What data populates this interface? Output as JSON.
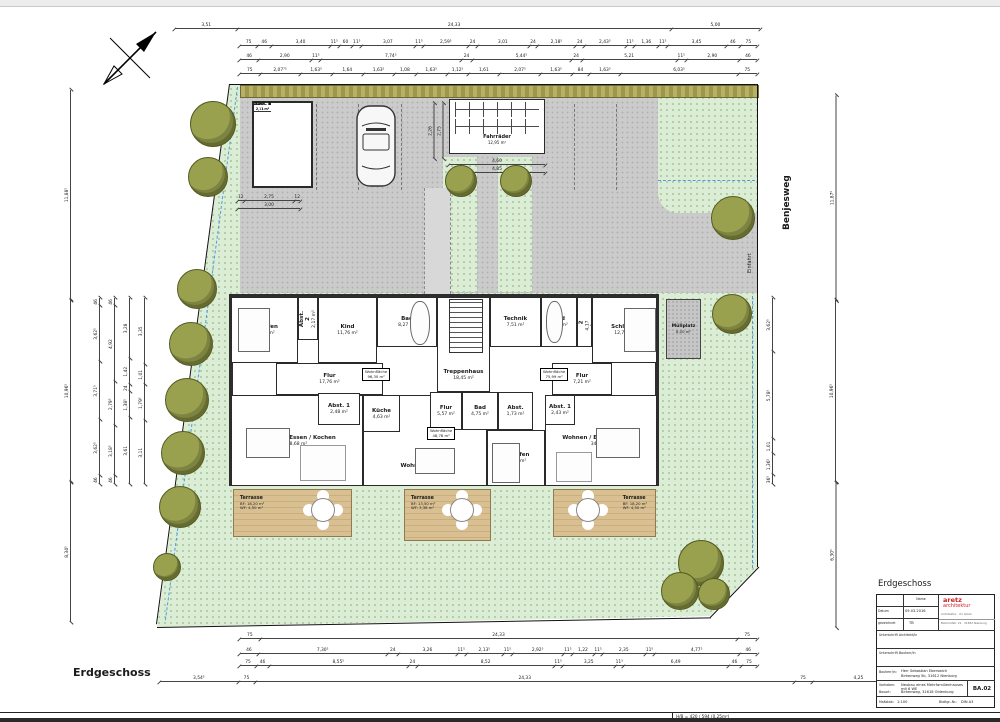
{
  "page": {
    "sheet_caption": "Erdgeschoss",
    "footer_text": "H/B = 420 / 594 (0.25m²)",
    "street_name": "Benjesweg",
    "driveway_label": "Einfahrt"
  },
  "hedge_labels": [
    {
      "t": "Hecke",
      "x": 70
    },
    {
      "t": "Hecke",
      "x": 420
    }
  ],
  "title_block": {
    "heading": "Erdgeschoss",
    "name_header": "Name",
    "date_label": "Datum",
    "date_value": "09.03.2016",
    "drawn_label": "gezeichnet",
    "drawn_value": "TB",
    "logo_line1": "aretz",
    "logo_line2": "architektur",
    "logo_sub1": "Architektur · Ihr Glück",
    "logo_sub2": "Bahnhofstr. 21 · 31582 Nienburg",
    "sig1": "Unterschrift Architekt/in",
    "sig2": "Unterschrift Bauherr/in",
    "client_label": "Bauherr/in:",
    "client_value1": "Herr Sebastian Eberswich",
    "client_value2": "Birkenweg 5b, 31612 Nienburg",
    "project_label": "Vorhaben:",
    "project_value": "Neubau eines Mehrfamilienhauses mit 6 WE",
    "site_label": "Bauort:",
    "site_value": "Birkenweg, 31618 Oldenburg",
    "sheet_no": "BA.02",
    "scale_label": "Maßstab:",
    "scale_value": "1:100",
    "format_label": "Blattgr.-Nr.:",
    "format_value": "DIN A3"
  },
  "rooms": [
    {
      "label": "Schlafen",
      "area": "17,83 m²",
      "x": 231,
      "y": 297,
      "w": 67,
      "h": 66
    },
    {
      "label": "Kind",
      "area": "11,76 m²",
      "x": 318,
      "y": 297,
      "w": 59,
      "h": 66
    },
    {
      "label": "Bad",
      "area": "8,27 m²",
      "x": 377,
      "y": 297,
      "w": 60,
      "h": 50
    },
    {
      "label": "Treppenhaus",
      "area": "18,45 m²",
      "x": 437,
      "y": 297,
      "w": 53,
      "h": 95,
      "cls": "low"
    },
    {
      "label": "Technik",
      "area": "7,51 m²",
      "x": 490,
      "y": 297,
      "w": 51,
      "h": 50
    },
    {
      "label": "Bad",
      "area": "8,54 m²",
      "x": 541,
      "y": 297,
      "w": 36,
      "h": 50
    },
    {
      "label": "Schlafen",
      "area": "12,71 m²",
      "x": 592,
      "y": 297,
      "w": 65,
      "h": 66
    },
    {
      "label": "Flur",
      "area": "17,76 m²",
      "x": 276,
      "y": 363,
      "w": 107,
      "h": 32
    },
    {
      "label": "Flur",
      "area": "7,21 m²",
      "x": 552,
      "y": 363,
      "w": 60,
      "h": 32
    },
    {
      "label": "Wohnen / Essen / Kochen",
      "area": "38,68 m²",
      "x": 231,
      "y": 395,
      "w": 132,
      "h": 91
    },
    {
      "label": "Wohnen / Essen",
      "area": "21,26 m²",
      "x": 363,
      "y": 395,
      "w": 124,
      "h": 91,
      "cls": "low"
    },
    {
      "label": "Wohnen / Essen / Kochen",
      "area": "34,06 m²",
      "x": 545,
      "y": 395,
      "w": 112,
      "h": 91
    },
    {
      "label": "Küche",
      "area": "4,63 m²",
      "x": 363,
      "y": 395,
      "w": 37,
      "h": 37
    },
    {
      "label": "Flur",
      "area": "5,57 m²",
      "x": 430,
      "y": 392,
      "w": 32,
      "h": 38
    },
    {
      "label": "Bad",
      "area": "4,75 m²",
      "x": 462,
      "y": 392,
      "w": 36,
      "h": 38
    },
    {
      "label": "Abst.",
      "area": "1,73 m²",
      "x": 498,
      "y": 392,
      "w": 35,
      "h": 38
    },
    {
      "label": "Schlafen",
      "area": "10,60 m²",
      "x": 487,
      "y": 430,
      "w": 58,
      "h": 56
    },
    {
      "label": "Abst. 1",
      "area": "2,48 m²",
      "x": 318,
      "y": 393,
      "w": 42,
      "h": 32
    },
    {
      "label": "Abst. 1",
      "area": "2,43 m²",
      "x": 545,
      "y": 395,
      "w": 30,
      "h": 30
    },
    {
      "label": "Abst. 2",
      "area": "2,17 m²",
      "x": 298,
      "y": 297,
      "w": 20,
      "h": 43,
      "rot": true
    },
    {
      "label": "Abst. 2",
      "area": "4,17 m²",
      "x": 577,
      "y": 297,
      "w": 15,
      "h": 50,
      "rot": true
    }
  ],
  "wf_boxes": [
    {
      "l1": "Wohnfläche",
      "l2": "96,30 m²",
      "x": 362,
      "y": 368
    },
    {
      "l1": "Wohnfläche",
      "l2": "48,78 m²",
      "x": 427,
      "y": 427
    },
    {
      "l1": "Wohnfläche",
      "l2": "75,99 m²",
      "x": 540,
      "y": 368
    }
  ],
  "storage_units": [
    {
      "label": "Abst. 1",
      "area": "2,11 m²"
    },
    {
      "label": "Abst. 2",
      "area": "2,11 m²"
    },
    {
      "label": "Abst. 3",
      "area": "2,11 m²"
    },
    {
      "label": "Abst. 4",
      "area": "2,11 m²"
    },
    {
      "label": "Abst. 5",
      "area": "2,11 m²"
    },
    {
      "label": "Abst. 6",
      "area": "2,11 m²"
    }
  ],
  "bike_area": {
    "label": "Fahrräder",
    "area": "12,95 m²"
  },
  "muellplatz": {
    "label": "Müllplatz",
    "area": "8,00 m²"
  },
  "stall_labels": [
    {
      "t": "Stellplatz 6",
      "x": 336
    },
    {
      "t": "Stellplatz 5",
      "x": 384
    },
    {
      "t": "Stellplatz 4",
      "x": 425
    },
    {
      "t": "Stellplatz 3",
      "x": 551
    },
    {
      "t": "Stellplatz 2",
      "x": 594
    },
    {
      "t": "Stellplatz 1",
      "x": 636
    }
  ],
  "stall_dividers": [
    {
      "x": 316
    },
    {
      "x": 358
    },
    {
      "x": 401
    },
    {
      "x": 574
    },
    {
      "x": 616
    }
  ],
  "islands": [
    {
      "x": 443,
      "y": 157,
      "w": 34,
      "h": 135
    },
    {
      "x": 498,
      "y": 157,
      "w": 34,
      "h": 135
    }
  ],
  "terraces": [
    {
      "label": "Terrasse",
      "bf": "BF: 18,20 m²",
      "wf": "WF: 4,50 m²",
      "x": 233,
      "y": 489,
      "w": 119,
      "h": 48
    },
    {
      "label": "Terrasse",
      "bf": "BF: 13,50 m²",
      "wf": "WF: 3,38 m²",
      "x": 404,
      "y": 489,
      "w": 87,
      "h": 52
    },
    {
      "label": "Terrasse",
      "bf": "BF: 18,20 m²",
      "wf": "WF: 4,50 m²",
      "x": 553,
      "y": 489,
      "w": 103,
      "h": 48,
      "flip": true
    }
  ],
  "trees": [
    {
      "x": 212,
      "y": 123,
      "r": 22
    },
    {
      "x": 207,
      "y": 176,
      "r": 19
    },
    {
      "x": 196,
      "y": 288,
      "r": 19
    },
    {
      "x": 190,
      "y": 343,
      "r": 21
    },
    {
      "x": 186,
      "y": 399,
      "r": 21
    },
    {
      "x": 182,
      "y": 452,
      "r": 21
    },
    {
      "x": 179,
      "y": 506,
      "r": 20
    },
    {
      "x": 166,
      "y": 566,
      "r": 13
    },
    {
      "x": 460,
      "y": 180,
      "r": 15
    },
    {
      "x": 515,
      "y": 180,
      "r": 15
    },
    {
      "x": 732,
      "y": 217,
      "r": 21
    },
    {
      "x": 731,
      "y": 313,
      "r": 19
    },
    {
      "x": 700,
      "y": 562,
      "r": 22
    },
    {
      "x": 679,
      "y": 590,
      "r": 18
    },
    {
      "x": 713,
      "y": 593,
      "r": 15
    }
  ],
  "furniture": [
    {
      "x": 238,
      "y": 308,
      "w": 30,
      "h": 42
    },
    {
      "x": 624,
      "y": 308,
      "w": 30,
      "h": 42
    },
    {
      "x": 492,
      "y": 443,
      "w": 26,
      "h": 38
    },
    {
      "x": 410,
      "y": 301,
      "w": 18,
      "h": 42,
      "cls": "round"
    },
    {
      "x": 546,
      "y": 301,
      "w": 15,
      "h": 40,
      "cls": "round"
    },
    {
      "x": 246,
      "y": 428,
      "w": 42,
      "h": 28
    },
    {
      "x": 415,
      "y": 448,
      "w": 38,
      "h": 24
    },
    {
      "x": 596,
      "y": 428,
      "w": 42,
      "h": 28
    },
    {
      "x": 300,
      "y": 445,
      "w": 44,
      "h": 34,
      "cls": "lite"
    },
    {
      "x": 556,
      "y": 452,
      "w": 34,
      "h": 28,
      "cls": "lite"
    },
    {
      "x": 449,
      "y": 299,
      "w": 32,
      "h": 52,
      "cls": "stairs"
    }
  ],
  "arrows": [
    {
      "g": "◄",
      "x": 418,
      "y": 362
    },
    {
      "g": "►",
      "x": 484,
      "y": 362
    },
    {
      "g": "◄",
      "x": 427,
      "y": 233
    },
    {
      "g": "◄",
      "x": 427,
      "y": 540
    }
  ],
  "dims": {
    "h": [
      {
        "x": 175,
        "y": 22,
        "w": 585,
        "labels": [
          [
            "3,51",
            3.5
          ],
          [
            "24,33",
            24.3
          ],
          [
            "5,00",
            5
          ]
        ]
      },
      {
        "x": 240,
        "y": 39,
        "w": 517,
        "labels": [
          [
            "75",
            1
          ],
          [
            "46",
            0.8
          ],
          [
            "3,40",
            3.4
          ],
          [
            "11⁵",
            0.5
          ],
          [
            "60",
            0.8
          ],
          [
            "11⁵",
            0.5
          ],
          [
            "3,07",
            3.1
          ],
          [
            "11⁵",
            0.5
          ],
          [
            "2,59⁵",
            2.6
          ],
          [
            "24",
            0.5
          ],
          [
            "3,01",
            3.0
          ],
          [
            "24",
            0.5
          ],
          [
            "2,18⁵",
            2.2
          ],
          [
            "24",
            0.5
          ],
          [
            "2,43⁵",
            2.4
          ],
          [
            "11⁵",
            0.5
          ],
          [
            "1,36",
            1.4
          ],
          [
            "11⁵",
            0.5
          ],
          [
            "3,45",
            3.4
          ],
          [
            "46",
            0.8
          ],
          [
            "75",
            1
          ]
        ]
      },
      {
        "x": 240,
        "y": 53,
        "w": 517,
        "labels": [
          [
            "46",
            1
          ],
          [
            "2,90",
            2.9
          ],
          [
            "11⁵",
            0.5
          ],
          [
            "7,74⁵",
            7.7
          ],
          [
            "24",
            0.6
          ],
          [
            "5,44⁵",
            5.4
          ],
          [
            "24",
            0.6
          ],
          [
            "5,21",
            5.2
          ],
          [
            "11⁵",
            0.5
          ],
          [
            "2,90",
            2.9
          ],
          [
            "46",
            1
          ]
        ]
      },
      {
        "x": 240,
        "y": 67,
        "w": 517,
        "labels": [
          [
            "75",
            1
          ],
          [
            "2,07⁷⁵",
            2.1
          ],
          [
            "1,63⁵",
            1.6
          ],
          [
            "1,64",
            1.6
          ],
          [
            "1,63⁵",
            1.6
          ],
          [
            "1,08",
            1.1
          ],
          [
            "1,63⁵",
            1.6
          ],
          [
            "1,12⁵",
            1.1
          ],
          [
            "1,61",
            1.6
          ],
          [
            "2,07⁵",
            2.1
          ],
          [
            "1,63⁵",
            1.6
          ],
          [
            "84",
            0.9
          ],
          [
            "1,63⁵",
            1.6
          ],
          [
            "6,03⁵",
            6.0
          ],
          [
            "75",
            1
          ]
        ]
      },
      {
        "x": 449,
        "y": 158,
        "w": 96,
        "labels": [
          [
            "4,60",
            1
          ]
        ]
      },
      {
        "x": 449,
        "y": 166,
        "w": 96,
        "labels": [
          [
            "4,85",
            1
          ]
        ]
      },
      {
        "x": 238,
        "y": 194,
        "w": 62,
        "labels": [
          [
            "12",
            0.25
          ],
          [
            "2,75",
            2.75
          ],
          [
            "12",
            0.25
          ]
        ]
      },
      {
        "x": 238,
        "y": 202,
        "w": 62,
        "labels": [
          [
            "3,00",
            1
          ]
        ]
      },
      {
        "x": 240,
        "y": 632,
        "w": 517,
        "labels": [
          [
            "75",
            1
          ],
          [
            "24,33",
            24.3
          ],
          [
            "75",
            1
          ]
        ]
      },
      {
        "x": 240,
        "y": 647,
        "w": 517,
        "labels": [
          [
            "46",
            1
          ],
          [
            "7,30⁵",
            7.3
          ],
          [
            "24",
            0.6
          ],
          [
            "3,26",
            3.3
          ],
          [
            "11⁵",
            0.5
          ],
          [
            "2,13⁵",
            2.1
          ],
          [
            "11⁵",
            0.5
          ],
          [
            "2,92⁵",
            2.9
          ],
          [
            "11⁵",
            0.5
          ],
          [
            "1,22",
            1.2
          ],
          [
            "11⁵",
            0.5
          ],
          [
            "2,35",
            2.4
          ],
          [
            "11⁵",
            0.5
          ],
          [
            "4,77⁵",
            4.8
          ],
          [
            "46",
            1
          ]
        ]
      },
      {
        "x": 240,
        "y": 659,
        "w": 517,
        "labels": [
          [
            "75",
            1
          ],
          [
            "46",
            0.8
          ],
          [
            "8,55⁵",
            8.6
          ],
          [
            "24",
            0.6
          ],
          [
            "8,52",
            8.5
          ],
          [
            "11⁵",
            0.5
          ],
          [
            "3,25",
            3.3
          ],
          [
            "11⁵",
            0.5
          ],
          [
            "6,49",
            6.5
          ],
          [
            "46",
            0.8
          ],
          [
            "75",
            1
          ]
        ]
      },
      {
        "x": 160,
        "y": 675,
        "w": 745,
        "labels": [
          [
            "3,54⁵",
            3.5
          ],
          [
            "75",
            0.8
          ],
          [
            "24,33",
            24.3
          ],
          [
            "75",
            0.8
          ],
          [
            "4,25",
            4.2
          ]
        ]
      }
    ],
    "v": [
      {
        "x": 68,
        "y": 90,
        "w": 210,
        "labels": [
          [
            "11,88⁵",
            1
          ]
        ]
      },
      {
        "x": 68,
        "y": 300,
        "w": 182,
        "labels": [
          [
            "10,96⁵",
            1
          ]
        ]
      },
      {
        "x": 68,
        "y": 482,
        "w": 140,
        "labels": [
          [
            "8,34⁵",
            1
          ]
        ]
      },
      {
        "x": 97,
        "y": 298,
        "w": 186,
        "labels": [
          [
            "46",
            0.5
          ],
          [
            "3,62⁵",
            3.6
          ],
          [
            "3,71⁵",
            3.7
          ],
          [
            "3,62⁵",
            3.6
          ],
          [
            "46",
            0.5
          ]
        ]
      },
      {
        "x": 112,
        "y": 298,
        "w": 186,
        "labels": [
          [
            "46",
            0.5
          ],
          [
            "3,18⁵",
            3.2
          ],
          [
            "2,79⁵",
            2.8
          ],
          [
            "4,92",
            4.9
          ],
          [
            "46",
            0.5
          ]
        ]
      },
      {
        "x": 127,
        "y": 298,
        "w": 186,
        "labels": [
          [
            "3,61",
            3.6
          ],
          [
            "1,38⁵",
            1.4
          ],
          [
            "24",
            0.4
          ],
          [
            "1,42",
            1.4
          ],
          [
            "3,28",
            3.3
          ]
        ]
      },
      {
        "x": 142,
        "y": 298,
        "w": 186,
        "labels": [
          [
            "3,11",
            3.1
          ],
          [
            "1,79⁵",
            1.8
          ],
          [
            "1,01",
            1.0
          ],
          [
            "3,35",
            3.3
          ]
        ]
      },
      {
        "x": 833,
        "y": 95,
        "w": 205,
        "labels": [
          [
            "11,87⁵",
            1
          ]
        ]
      },
      {
        "x": 833,
        "y": 300,
        "w": 182,
        "labels": [
          [
            "10,96⁵",
            1
          ]
        ]
      },
      {
        "x": 833,
        "y": 482,
        "w": 145,
        "labels": [
          [
            "6,30⁵",
            1
          ]
        ]
      },
      {
        "x": 770,
        "y": 298,
        "w": 186,
        "labels": [
          [
            "36⁵",
            0.6
          ],
          [
            "1,36⁵",
            1.4
          ],
          [
            "1,01",
            1.0
          ],
          [
            "5,78⁵",
            5.8
          ],
          [
            "3,62⁵",
            3.6
          ]
        ]
      },
      {
        "x": 431,
        "y": 103,
        "w": 55,
        "labels": [
          [
            "2,26",
            1
          ]
        ]
      },
      {
        "x": 440,
        "y": 103,
        "w": 55,
        "labels": [
          [
            "2,75",
            1
          ]
        ]
      }
    ]
  }
}
